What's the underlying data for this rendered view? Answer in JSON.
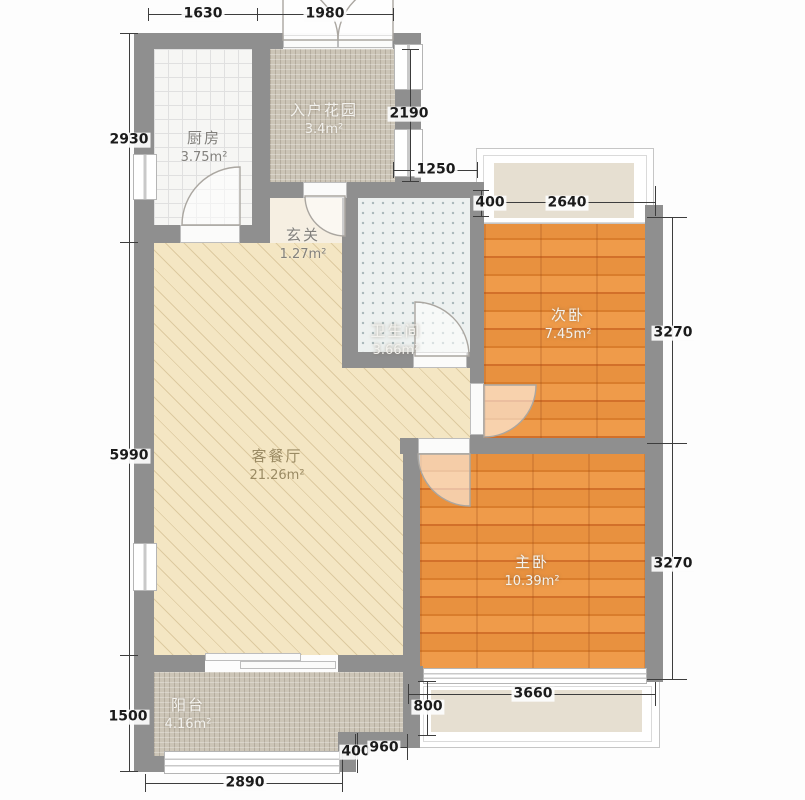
{
  "meta": {
    "type": "apartment-floor-plan"
  },
  "rooms": {
    "kitchen": {
      "name": "厨房",
      "area": "3.75m²"
    },
    "entry_garden": {
      "name": "入户花园",
      "area": "3.4m²"
    },
    "foyer": {
      "name": "玄关",
      "area": "1.27m²"
    },
    "bathroom": {
      "name": "卫生间",
      "area": "3.66m²"
    },
    "second_bedroom": {
      "name": "次卧",
      "area": "7.45m²"
    },
    "living_dining": {
      "name": "客餐厅",
      "area": "21.26m²"
    },
    "master_bedroom": {
      "name": "主卧",
      "area": "10.39m²"
    },
    "balcony": {
      "name": "阳台",
      "area": "4.16m²"
    }
  },
  "dimensions": {
    "top_left": "1630",
    "top_right": "1980",
    "left_top": "2930",
    "left_middle": "5990",
    "left_bottom": "1500",
    "garden_height": "2190",
    "bathroom_width": "1250",
    "bay_top_depth": "400",
    "bay_top_width": "2640",
    "bedroom2_height": "3270",
    "master_height": "3270",
    "balcony_width": "2890",
    "step_depth": "400",
    "step_width": "960",
    "bay_bottom_depth": "800",
    "bay_bottom_width": "3660"
  },
  "colors": {
    "wall": "#8f8f8f",
    "wood_floor": "#e78c3b",
    "living_floor": "#f4e6c3",
    "mosaic_floor": "#ccc5b7",
    "bathroom_floor": "#edf1f0",
    "kitchen_floor": "#f6f6f4",
    "bay_fill": "#e6dfd1",
    "dimension_text": "#1b1b1b"
  }
}
